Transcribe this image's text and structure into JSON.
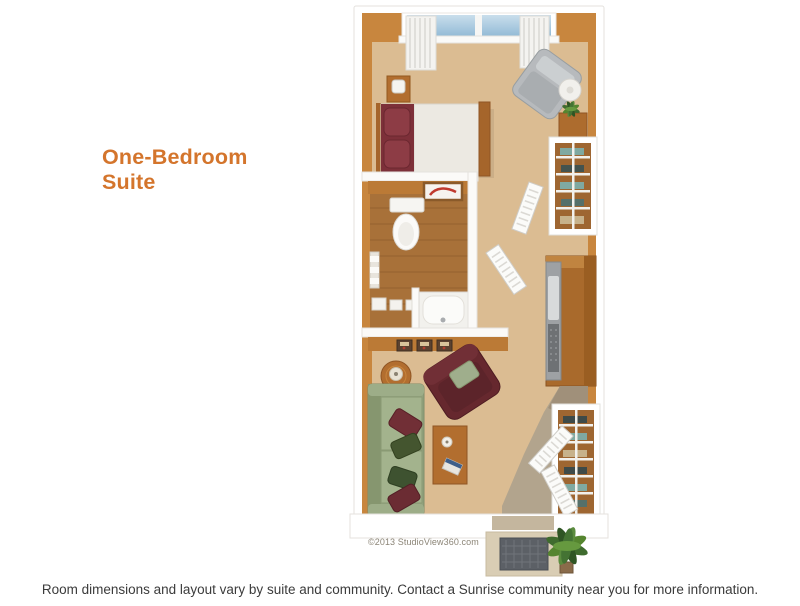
{
  "title": {
    "line1": "One-Bedroom",
    "line2": "Suite"
  },
  "floorplan": {
    "copyright": "©2013 StudioView360.com",
    "colors": {
      "title_orange": "#D4752C",
      "wall_orange": "#C8863E",
      "wall_face_orange": "#BB7A36",
      "floor_tan": "#DBBC92",
      "bathroom_wood": "#A87139",
      "entry_taupe": "#B2A48D",
      "outer_walls_white": "#FFFFFF",
      "window_glass_blue": "#9CC1DA",
      "sofa_green": "#93A37E",
      "armchair_maroon": "#66282E",
      "bed_blanket_maroon": "#7D3039",
      "recliner_gray": "#B7BABD",
      "kitchen_wood": "#A96A2C",
      "doormat_gray": "#5C6066",
      "plant_green": "#3F6B2E"
    }
  },
  "caption": "Room dimensions and layout vary by suite and community. Contact a Sunrise community near you for more information."
}
